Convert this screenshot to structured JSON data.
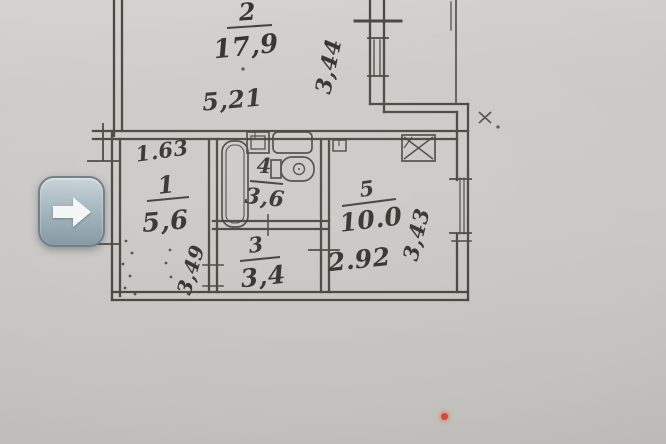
{
  "viewer": {
    "next_button_icon": "arrow-right"
  },
  "plan": {
    "rooms": {
      "r1": {
        "number": "1",
        "area": "5,6",
        "dim_width": "1.63",
        "dim_height": "3,49"
      },
      "r2": {
        "number": "2",
        "area": "17,9",
        "dim_width": "5,21",
        "dim_height": "3,44"
      },
      "r3": {
        "number": "3",
        "area": "3,4"
      },
      "r4": {
        "number": "4",
        "area": "3,6"
      },
      "r5": {
        "number": "5",
        "area": "10.0",
        "dim_width": "2.92",
        "dim_height": "3,43"
      }
    },
    "colors": {
      "ink": "#39362f",
      "paper": "#c9c7c3",
      "red_dot": "#d9472b",
      "arrow_button_top": "#c6d2d7",
      "arrow_button_bottom": "#80949e"
    }
  }
}
